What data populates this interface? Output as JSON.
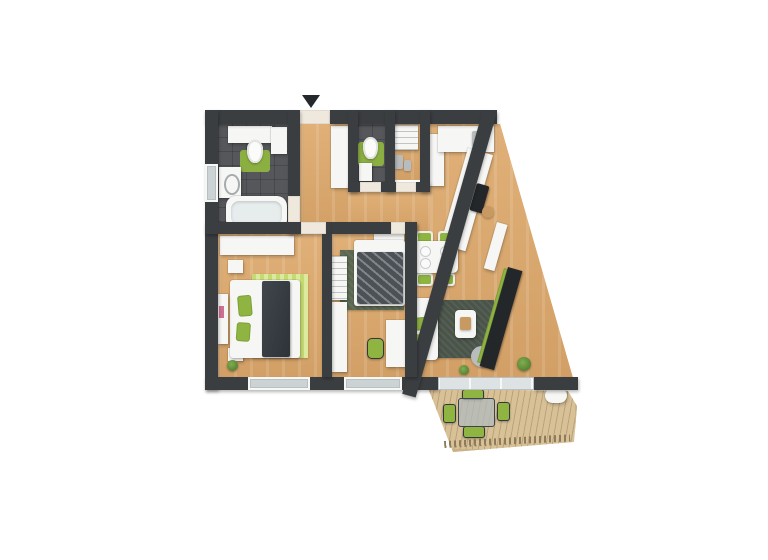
{
  "scene": {
    "type": "3d-apartment-floor-plan-render",
    "background": "#ffffff",
    "entrance_marker": "down-arrow"
  },
  "palette": {
    "wall": "#3b3e41",
    "wood_light": "#e0b078",
    "wood_dark": "#d2a066",
    "tile": "#55575b",
    "furniture_white": "#f6f6f4",
    "accent_green": "#8fb441",
    "rug_lime_1": "#c6da72",
    "rug_lime_2": "#dcea9d",
    "rug_sage": "#5c6852",
    "rug_sage_dark": "#4a5449",
    "deck": "#d8c197",
    "deck_line": "#8d7c5b",
    "glass": "#ccd3d5",
    "tv_dark": "#24272a",
    "door_floor": "#efe8dd",
    "plant_green": "#49702c",
    "plant_light": "#7fae4e",
    "accent_pink": "#cf6f93",
    "object_grey": "#b9bcbd",
    "wood_tone": "#c89a62",
    "arrow": "#26292c"
  },
  "rooms": [
    {
      "name": "bathroom",
      "furniture": [
        "vanity-sink",
        "wall-cabinet",
        "toilet",
        "green-rug",
        "washing-machine",
        "bathtub"
      ]
    },
    {
      "name": "entry-hall",
      "furniture": [
        "wardrobe"
      ]
    },
    {
      "name": "wc",
      "furniture": [
        "toilet",
        "washbasin",
        "green-rug"
      ]
    },
    {
      "name": "storage",
      "furniture": [
        "shelving",
        "cleaning-items"
      ]
    },
    {
      "name": "kitchen",
      "furniture": [
        "fridge",
        "l-shaped-counter",
        "sink",
        "cooktop",
        "stool"
      ]
    },
    {
      "name": "bedroom",
      "furniture": [
        "double-bed",
        "wardrobe",
        "nightstands",
        "lime-striped-rug",
        "dresser",
        "plant"
      ]
    },
    {
      "name": "kids-room",
      "furniture": [
        "single-bed",
        "desk",
        "chair",
        "wardrobe",
        "shelf",
        "sage-rug"
      ]
    },
    {
      "name": "living-dining",
      "furniture": [
        "dining-table",
        "four-chairs",
        "sofa",
        "coffee-table",
        "pouf",
        "dark-rug",
        "tv-sideboard",
        "radiator-shelf",
        "plants"
      ]
    },
    {
      "name": "terrace",
      "furniture": [
        "wood-deck",
        "outdoor-table",
        "four-chairs",
        "lounger",
        "railing"
      ]
    }
  ],
  "plan": {
    "items": [
      {
        "n": "terrace-deck",
        "c": "deck",
        "x": 428,
        "y": 386,
        "w": 150,
        "h": 66,
        "cp": "polygon(0px 2px, 140px 5px, 149px 20px, 146px 56px, 25px 66px)"
      },
      {
        "n": "terrace-railing",
        "c": "rail",
        "x": 444,
        "y": 441,
        "w": 126,
        "h": 7,
        "r": -3
      },
      {
        "n": "terrace-chair-top",
        "c": "ochair",
        "x": 462,
        "y": 389,
        "w": 22,
        "h": 11,
        "br": 3
      },
      {
        "n": "terrace-chair-left",
        "c": "ochair",
        "x": 443,
        "y": 404,
        "w": 13,
        "h": 19,
        "br": 3
      },
      {
        "n": "terrace-chair-right",
        "c": "ochair",
        "x": 497,
        "y": 402,
        "w": 13,
        "h": 19,
        "br": 3
      },
      {
        "n": "terrace-chair-bottom",
        "c": "ochair",
        "x": 463,
        "y": 426,
        "w": 22,
        "h": 12,
        "br": 3
      },
      {
        "n": "terrace-table",
        "c": "glass",
        "x": 458,
        "y": 398,
        "w": 37,
        "h": 29,
        "br": 3
      },
      {
        "n": "terrace-lounger",
        "c": "w",
        "x": 545,
        "y": 388,
        "w": 22,
        "h": 15,
        "br": 8
      },
      {
        "n": "corridor-floor",
        "c": "wood",
        "x": 300,
        "y": 124,
        "w": 48,
        "h": 110
      },
      {
        "n": "hall-floor",
        "c": "wood",
        "x": 348,
        "y": 190,
        "w": 82,
        "h": 44
      },
      {
        "n": "living-kitchen-floor",
        "c": "wood",
        "x": 430,
        "y": 124,
        "w": 146,
        "h": 254,
        "cp": "polygon(0px 0px, 70px 0px, 143px 254px, 0px 254px)"
      },
      {
        "n": "living-floor-strip",
        "c": "wood",
        "x": 417,
        "y": 234,
        "w": 13,
        "h": 144
      },
      {
        "n": "bedroom-floor",
        "c": "wood",
        "x": 218,
        "y": 234,
        "w": 104,
        "h": 143
      },
      {
        "n": "kids-room-floor",
        "c": "wood",
        "x": 332,
        "y": 234,
        "w": 73,
        "h": 143
      },
      {
        "n": "bathroom-floor",
        "c": "tile",
        "x": 218,
        "y": 124,
        "w": 70,
        "h": 98
      },
      {
        "n": "wc-floor",
        "c": "tile",
        "x": 358,
        "y": 124,
        "w": 27,
        "h": 58
      },
      {
        "n": "storage-floor",
        "c": "wood",
        "x": 395,
        "y": 124,
        "w": 25,
        "h": 56
      },
      {
        "n": "bedroom-rug",
        "c": "ruglime",
        "x": 252,
        "y": 274,
        "w": 56,
        "h": 84
      },
      {
        "n": "kids-rug",
        "c": "rugsage",
        "x": 340,
        "y": 250,
        "w": 64,
        "h": 60
      },
      {
        "n": "living-rug",
        "c": "rugsage dark",
        "x": 436,
        "y": 300,
        "w": 58,
        "h": 58
      },
      {
        "n": "bathroom-rug",
        "c": "g rug",
        "x": 240,
        "y": 150,
        "w": 30,
        "h": 22,
        "br": 3
      },
      {
        "n": "wc-rug",
        "c": "g rug",
        "x": 358,
        "y": 142,
        "w": 26,
        "h": 24,
        "br": 3
      },
      {
        "n": "bathroom-vanity",
        "c": "w",
        "x": 228,
        "y": 126,
        "w": 44,
        "h": 17
      },
      {
        "n": "bathroom-cabinet",
        "c": "w",
        "x": 271,
        "y": 127,
        "w": 16,
        "h": 27
      },
      {
        "n": "bathroom-toilet",
        "c": "wcb",
        "x": 247,
        "y": 140,
        "w": 16,
        "h": 23
      },
      {
        "n": "washing-machine",
        "c": "w wm",
        "x": 219,
        "y": 167,
        "w": 22,
        "h": 31
      },
      {
        "n": "bathtub",
        "c": "tub",
        "x": 226,
        "y": 196,
        "w": 61,
        "h": 34,
        "br": 10
      },
      {
        "n": "bathtub-inner",
        "c": "tubin",
        "x": 231,
        "y": 201,
        "w": 51,
        "h": 24,
        "br": 8
      },
      {
        "n": "wc-toilet",
        "c": "wcb",
        "x": 363,
        "y": 137,
        "w": 15,
        "h": 22
      },
      {
        "n": "wc-basin",
        "c": "w",
        "x": 359,
        "y": 163,
        "w": 13,
        "h": 18
      },
      {
        "n": "storage-shelf",
        "c": "w shelf",
        "x": 392,
        "y": 125,
        "w": 26,
        "h": 25
      },
      {
        "n": "storage-item-1",
        "c": "grey",
        "x": 394,
        "y": 155,
        "w": 9,
        "h": 14,
        "br": 2
      },
      {
        "n": "storage-item-2",
        "c": "grey",
        "x": 404,
        "y": 160,
        "w": 7,
        "h": 11,
        "br": 2
      },
      {
        "n": "hall-wardrobe",
        "c": "w",
        "x": 331,
        "y": 126,
        "w": 17,
        "h": 62
      },
      {
        "n": "fridge",
        "c": "w",
        "x": 428,
        "y": 134,
        "w": 16,
        "h": 52
      },
      {
        "n": "kitchen-counter-top",
        "c": "w",
        "x": 438,
        "y": 126,
        "w": 56,
        "h": 26
      },
      {
        "n": "kitchen-sink",
        "c": "grey",
        "x": 472,
        "y": 131,
        "w": 14,
        "h": 15,
        "br": 2
      },
      {
        "n": "kitchen-counter-diagonal",
        "c": "w",
        "x": 468,
        "y": 148,
        "w": 26,
        "h": 100,
        "r": 16
      },
      {
        "n": "kitchen-cooktop",
        "c": "tvp",
        "x": 477,
        "y": 183,
        "w": 13,
        "h": 28,
        "r": 16,
        "br": 2
      },
      {
        "n": "kitchen-board",
        "c": "g",
        "x": 472,
        "y": 164,
        "w": 9,
        "h": 11,
        "r": 16
      },
      {
        "n": "kitchen-stool",
        "c": "wd",
        "x": 482,
        "y": 206,
        "w": 12,
        "h": 12,
        "br": 12
      },
      {
        "n": "dining-chair-1",
        "c": "chair",
        "x": 416,
        "y": 231,
        "w": 17,
        "h": 13,
        "br": 3
      },
      {
        "n": "dining-chair-2",
        "c": "chair",
        "x": 438,
        "y": 231,
        "w": 17,
        "h": 13,
        "br": 3
      },
      {
        "n": "dining-chair-3",
        "c": "chair",
        "x": 416,
        "y": 273,
        "w": 17,
        "h": 13,
        "br": 3
      },
      {
        "n": "dining-chair-4",
        "c": "chair",
        "x": 438,
        "y": 273,
        "w": 17,
        "h": 13,
        "br": 3
      },
      {
        "n": "dining-table",
        "c": "w",
        "x": 413,
        "y": 241,
        "w": 45,
        "h": 32,
        "br": 5
      },
      {
        "n": "plate-1",
        "c": "grey plate",
        "x": 421,
        "y": 247,
        "w": 9,
        "h": 9,
        "br": 9
      },
      {
        "n": "plate-2",
        "c": "grey plate",
        "x": 441,
        "y": 247,
        "w": 9,
        "h": 9,
        "br": 9
      },
      {
        "n": "plate-3",
        "c": "grey plate",
        "x": 421,
        "y": 259,
        "w": 9,
        "h": 9,
        "br": 9
      },
      {
        "n": "plate-4",
        "c": "grey plate",
        "x": 441,
        "y": 259,
        "w": 9,
        "h": 9,
        "br": 9
      },
      {
        "n": "sofa",
        "c": "w",
        "x": 412,
        "y": 298,
        "w": 26,
        "h": 62,
        "br": 4
      },
      {
        "n": "sofa-pillow-1",
        "c": "g",
        "x": 414,
        "y": 318,
        "w": 12,
        "h": 13,
        "br": 3,
        "r": -6
      },
      {
        "n": "sofa-pillow-2",
        "c": "g",
        "x": 414,
        "y": 334,
        "w": 12,
        "h": 13,
        "br": 3,
        "r": 5
      },
      {
        "n": "coffee-table",
        "c": "w",
        "x": 455,
        "y": 310,
        "w": 21,
        "h": 28,
        "br": 4
      },
      {
        "n": "coffee-tray",
        "c": "wd",
        "x": 460,
        "y": 317,
        "w": 11,
        "h": 13,
        "br": 2
      },
      {
        "n": "pouf",
        "c": "grey",
        "x": 471,
        "y": 346,
        "w": 23,
        "h": 21,
        "br": 12
      },
      {
        "n": "radiator-shelf",
        "c": "w",
        "x": 497,
        "y": 222,
        "w": 11,
        "h": 48,
        "r": 16
      },
      {
        "n": "tv-accent",
        "c": "g",
        "x": 504,
        "y": 268,
        "w": 4,
        "h": 98,
        "r": 16
      },
      {
        "n": "tv-sideboard",
        "c": "tvp",
        "x": 508,
        "y": 267,
        "w": 15,
        "h": 103,
        "r": 16
      },
      {
        "n": "living-plant",
        "c": "plant",
        "x": 517,
        "y": 357,
        "w": 14,
        "h": 14
      },
      {
        "n": "door-plant",
        "c": "plant",
        "x": 459,
        "y": 365,
        "w": 10,
        "h": 10
      },
      {
        "n": "bedroom-wardrobe",
        "c": "w",
        "x": 220,
        "y": 236,
        "w": 74,
        "h": 19
      },
      {
        "n": "nightstand-north",
        "c": "w",
        "x": 228,
        "y": 260,
        "w": 15,
        "h": 13
      },
      {
        "n": "nightstand-south",
        "c": "w",
        "x": 228,
        "y": 348,
        "w": 15,
        "h": 13
      },
      {
        "n": "double-bed",
        "c": "w",
        "x": 230,
        "y": 280,
        "w": 70,
        "h": 78,
        "br": 3
      },
      {
        "n": "bed-blanket",
        "c": "dk",
        "x": 262,
        "y": 281,
        "w": 28,
        "h": 76,
        "br": 2
      },
      {
        "n": "bed-pillow-1",
        "c": "g",
        "x": 237,
        "y": 296,
        "w": 14,
        "h": 21,
        "br": 3,
        "r": -5
      },
      {
        "n": "bed-pillow-2",
        "c": "g",
        "x": 237,
        "y": 322,
        "w": 14,
        "h": 19,
        "br": 3,
        "r": 4
      },
      {
        "n": "bedroom-dresser",
        "c": "w",
        "x": 218,
        "y": 294,
        "w": 10,
        "h": 50
      },
      {
        "n": "dresser-accent",
        "c": "pink",
        "x": 219,
        "y": 306,
        "w": 5,
        "h": 12
      },
      {
        "n": "bedroom-plant",
        "c": "plant",
        "x": 227,
        "y": 360,
        "w": 11,
        "h": 11
      },
      {
        "n": "kids-shelf",
        "c": "w shelf",
        "x": 330,
        "y": 256,
        "w": 17,
        "h": 44
      },
      {
        "n": "kids-wardrobe",
        "c": "w",
        "x": 328,
        "y": 302,
        "w": 19,
        "h": 70
      },
      {
        "n": "kids-bed-headboard",
        "c": "w",
        "x": 374,
        "y": 234,
        "w": 30,
        "h": 13
      },
      {
        "n": "kids-bed",
        "c": "w",
        "x": 354,
        "y": 240,
        "w": 51,
        "h": 66,
        "br": 3
      },
      {
        "n": "kids-blanket",
        "c": "dkp",
        "x": 357,
        "y": 252,
        "w": 46,
        "h": 52,
        "br": 2
      },
      {
        "n": "kids-desk",
        "c": "w",
        "x": 386,
        "y": 320,
        "w": 21,
        "h": 47
      },
      {
        "n": "kids-chair",
        "c": "ochair",
        "x": 367,
        "y": 338,
        "w": 17,
        "h": 21,
        "br": 5
      },
      {
        "n": "wall-top-left",
        "c": "wall",
        "x": 205,
        "y": 110,
        "w": 87,
        "h": 14
      },
      {
        "n": "entrance-door",
        "c": "door",
        "x": 292,
        "y": 110,
        "w": 38,
        "h": 14
      },
      {
        "n": "wall-top-right",
        "c": "wall",
        "x": 330,
        "y": 110,
        "w": 167,
        "h": 14
      },
      {
        "n": "wall-left",
        "c": "wall",
        "x": 205,
        "y": 110,
        "w": 13,
        "h": 280
      },
      {
        "n": "bathroom-window-west",
        "c": "win",
        "x": 205,
        "y": 164,
        "w": 13,
        "h": 38
      },
      {
        "n": "wall-bottom",
        "c": "wall",
        "x": 205,
        "y": 377,
        "w": 233,
        "h": 13
      },
      {
        "n": "wall-bottom-right",
        "c": "wall",
        "x": 534,
        "y": 377,
        "w": 44,
        "h": 13
      },
      {
        "n": "wall-diagonal",
        "c": "wall",
        "x": 483,
        "y": 110,
        "w": 14,
        "h": 295,
        "r": 15.9
      },
      {
        "n": "wall-bathroom-east",
        "c": "wall",
        "x": 288,
        "y": 110,
        "w": 12,
        "h": 124
      },
      {
        "n": "bathroom-door",
        "c": "door",
        "x": 288,
        "y": 196,
        "w": 12,
        "h": 28
      },
      {
        "n": "wall-bedroom-north",
        "c": "wall",
        "x": 205,
        "y": 222,
        "w": 127,
        "h": 12
      },
      {
        "n": "bedroom-door",
        "c": "door",
        "x": 301,
        "y": 222,
        "w": 25,
        "h": 12
      },
      {
        "n": "wall-kids-north",
        "c": "wall",
        "x": 332,
        "y": 222,
        "w": 85,
        "h": 12
      },
      {
        "n": "kids-door",
        "c": "door",
        "x": 391,
        "y": 222,
        "w": 20,
        "h": 12
      },
      {
        "n": "wall-kids-west",
        "c": "wall",
        "x": 322,
        "y": 234,
        "w": 10,
        "h": 143
      },
      {
        "n": "wall-kids-east",
        "c": "wall",
        "x": 405,
        "y": 222,
        "w": 12,
        "h": 155
      },
      {
        "n": "wall-wc-west",
        "c": "wall",
        "x": 348,
        "y": 110,
        "w": 10,
        "h": 82
      },
      {
        "n": "wall-wc-east",
        "c": "wall",
        "x": 385,
        "y": 110,
        "w": 10,
        "h": 82
      },
      {
        "n": "wall-storage-east",
        "c": "wall",
        "x": 420,
        "y": 110,
        "w": 10,
        "h": 82
      },
      {
        "n": "wall-wc-south",
        "c": "wall",
        "x": 348,
        "y": 182,
        "w": 82,
        "h": 10
      },
      {
        "n": "wc-door",
        "c": "door",
        "x": 360,
        "y": 182,
        "w": 21,
        "h": 10
      },
      {
        "n": "storage-door",
        "c": "door",
        "x": 396,
        "y": 182,
        "w": 20,
        "h": 10
      },
      {
        "n": "bedroom-window-south",
        "c": "win",
        "x": 248,
        "y": 377,
        "w": 62,
        "h": 13
      },
      {
        "n": "kids-window-south",
        "c": "win",
        "x": 344,
        "y": 377,
        "w": 58,
        "h": 13
      },
      {
        "n": "terrace-slider",
        "c": "wing",
        "x": 438,
        "y": 377,
        "w": 96,
        "h": 13
      },
      {
        "n": "entrance-arrow",
        "c": "arrow",
        "x": 302,
        "y": 95,
        "w": 0,
        "h": 0
      }
    ]
  }
}
